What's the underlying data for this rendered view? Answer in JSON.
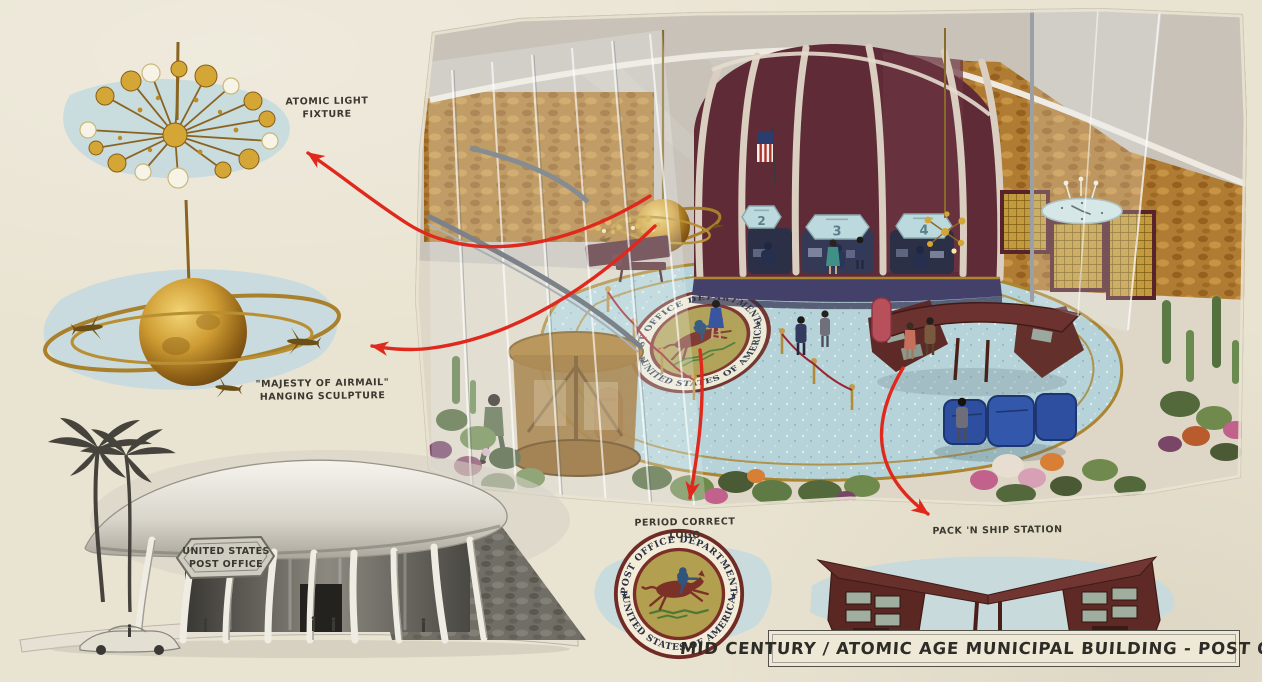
{
  "title_block": {
    "title": "Mid Century / Atomic Age Municipal Building - Post Office"
  },
  "callouts": {
    "light_fixture_label": "Atomic Light Fixture",
    "airmail_label_1": "\"Majesty of Airmail\"",
    "airmail_label_2": "Hanging Sculpture",
    "logo_label": "Period Correct Logo",
    "pack_ship_label": "Pack 'N Ship Station"
  },
  "building_sign": {
    "line1": "United States",
    "line2": "Post Office"
  },
  "seal": {
    "top": "POST OFFICE DEPARTMENT",
    "bottom": "UNITED STATES OF AMERICA",
    "left_star": "★",
    "right_star": "★"
  },
  "service_windows": [
    "2",
    "3",
    "4"
  ],
  "colors": {
    "paper": "#e9e3d1",
    "wash-blue": "#c5dade",
    "arrow-red": "#e0281c",
    "counter-maroon": "#5e2b36",
    "floor-blue": "#b5d3d8",
    "brass-gold": "#b08b3a",
    "seal-olive": "#b2a050",
    "seal-maroon": "#702b26",
    "wood-dark": "#5c2822",
    "ink": "#3b382f"
  }
}
